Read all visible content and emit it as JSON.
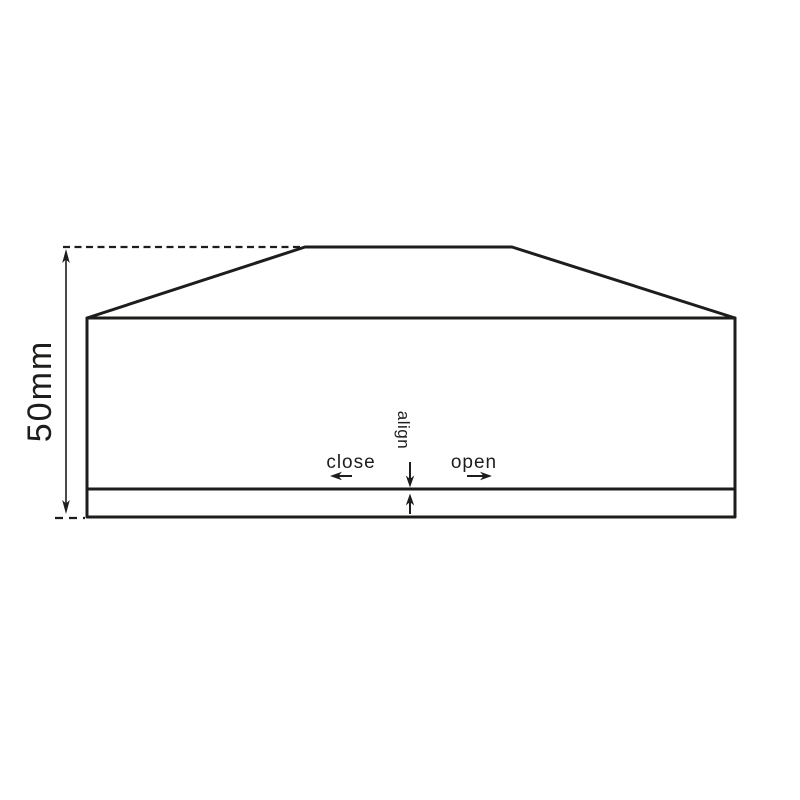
{
  "diagram": {
    "labels": {
      "dimension": "50mm",
      "close": "close",
      "align": "align",
      "open": "open"
    },
    "colors": {
      "line": "#1d1d1b",
      "background": "#ffffff"
    }
  }
}
